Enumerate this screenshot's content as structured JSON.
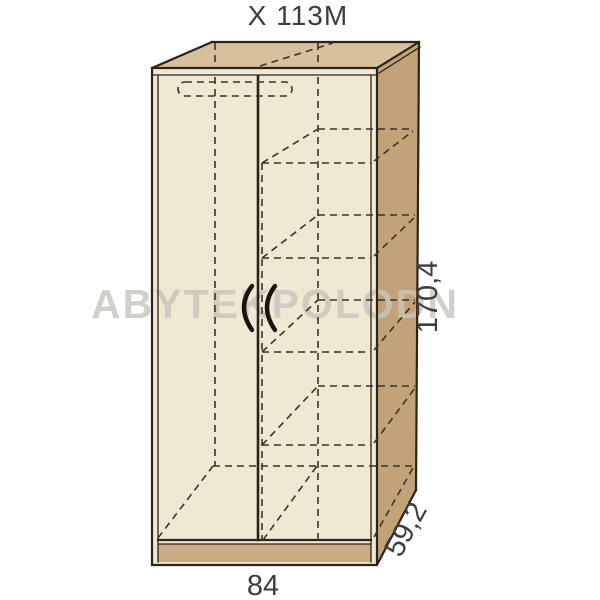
{
  "title": "X 113M",
  "watermark_text": "ABYTEKPOLODN",
  "dimensions": {
    "height": "170,4",
    "width": "84",
    "depth": "59,2"
  },
  "colors": {
    "face_top": "#d7c09c",
    "face_side": "#c2a379",
    "face_front": "#f1e8d4",
    "plinth": "#c9ac83",
    "line": "#2a241c",
    "dash": "#3a332a",
    "handle": "#17130e",
    "text": "#3d3d3d",
    "watermark": "#c9c5bc"
  }
}
